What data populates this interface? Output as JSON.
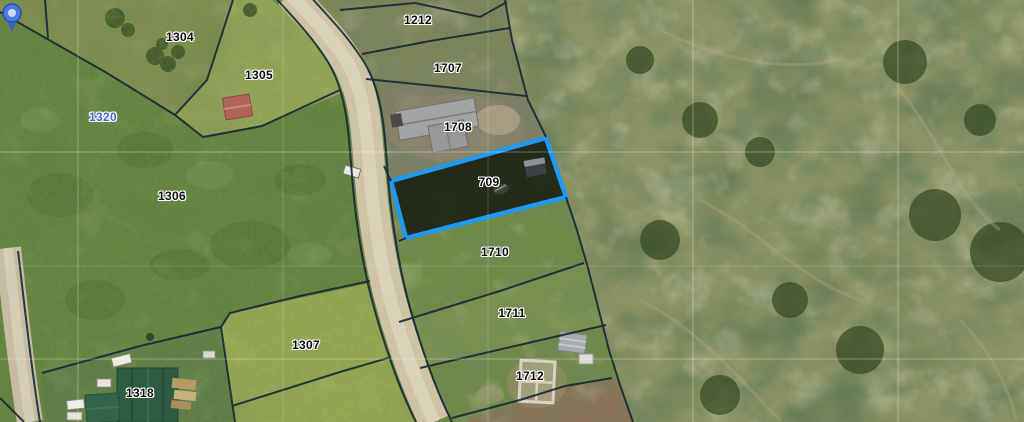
{
  "map": {
    "type_note": "aerial cadastral map view",
    "parcel_labels": [
      {
        "label": "1304",
        "x": 180,
        "y": 37,
        "color": "dark"
      },
      {
        "label": "1305",
        "x": 259,
        "y": 75,
        "color": "dark"
      },
      {
        "label": "1320",
        "x": 103,
        "y": 117,
        "color": "blue"
      },
      {
        "label": "1306",
        "x": 172,
        "y": 196,
        "color": "dark"
      },
      {
        "label": "1212",
        "x": 418,
        "y": 20,
        "color": "dark"
      },
      {
        "label": "1707",
        "x": 448,
        "y": 68,
        "color": "dark"
      },
      {
        "label": "1708",
        "x": 458,
        "y": 127,
        "color": "dark"
      },
      {
        "label": "709",
        "x": 489,
        "y": 182,
        "color": "dark",
        "selected": true
      },
      {
        "label": "1710",
        "x": 495,
        "y": 252,
        "color": "dark"
      },
      {
        "label": "1711",
        "x": 512,
        "y": 313,
        "color": "dark"
      },
      {
        "label": "1307",
        "x": 306,
        "y": 345,
        "color": "dark"
      },
      {
        "label": "1712",
        "x": 530,
        "y": 376,
        "color": "dark"
      },
      {
        "label": "1318",
        "x": 140,
        "y": 393,
        "color": "dark"
      }
    ],
    "selected_parcel": {
      "label": "709",
      "outline_color": "#1f99f5",
      "fill": "rgba(12,16,6,0.78)"
    },
    "marker": {
      "name": "map-pin",
      "head_color": "#4a79e8",
      "tail_color": "#3b62c8",
      "center_color": "#cdd8ef",
      "x": 467,
      "y": 185
    },
    "label_text_color": "#0a0a0a",
    "label_halo_color": "#ffffff",
    "alt_label_color": "#3a6bd6",
    "boundary_color": "#142636",
    "grid_color": "#ffffff",
    "road_color": "#cfc3a6"
  }
}
